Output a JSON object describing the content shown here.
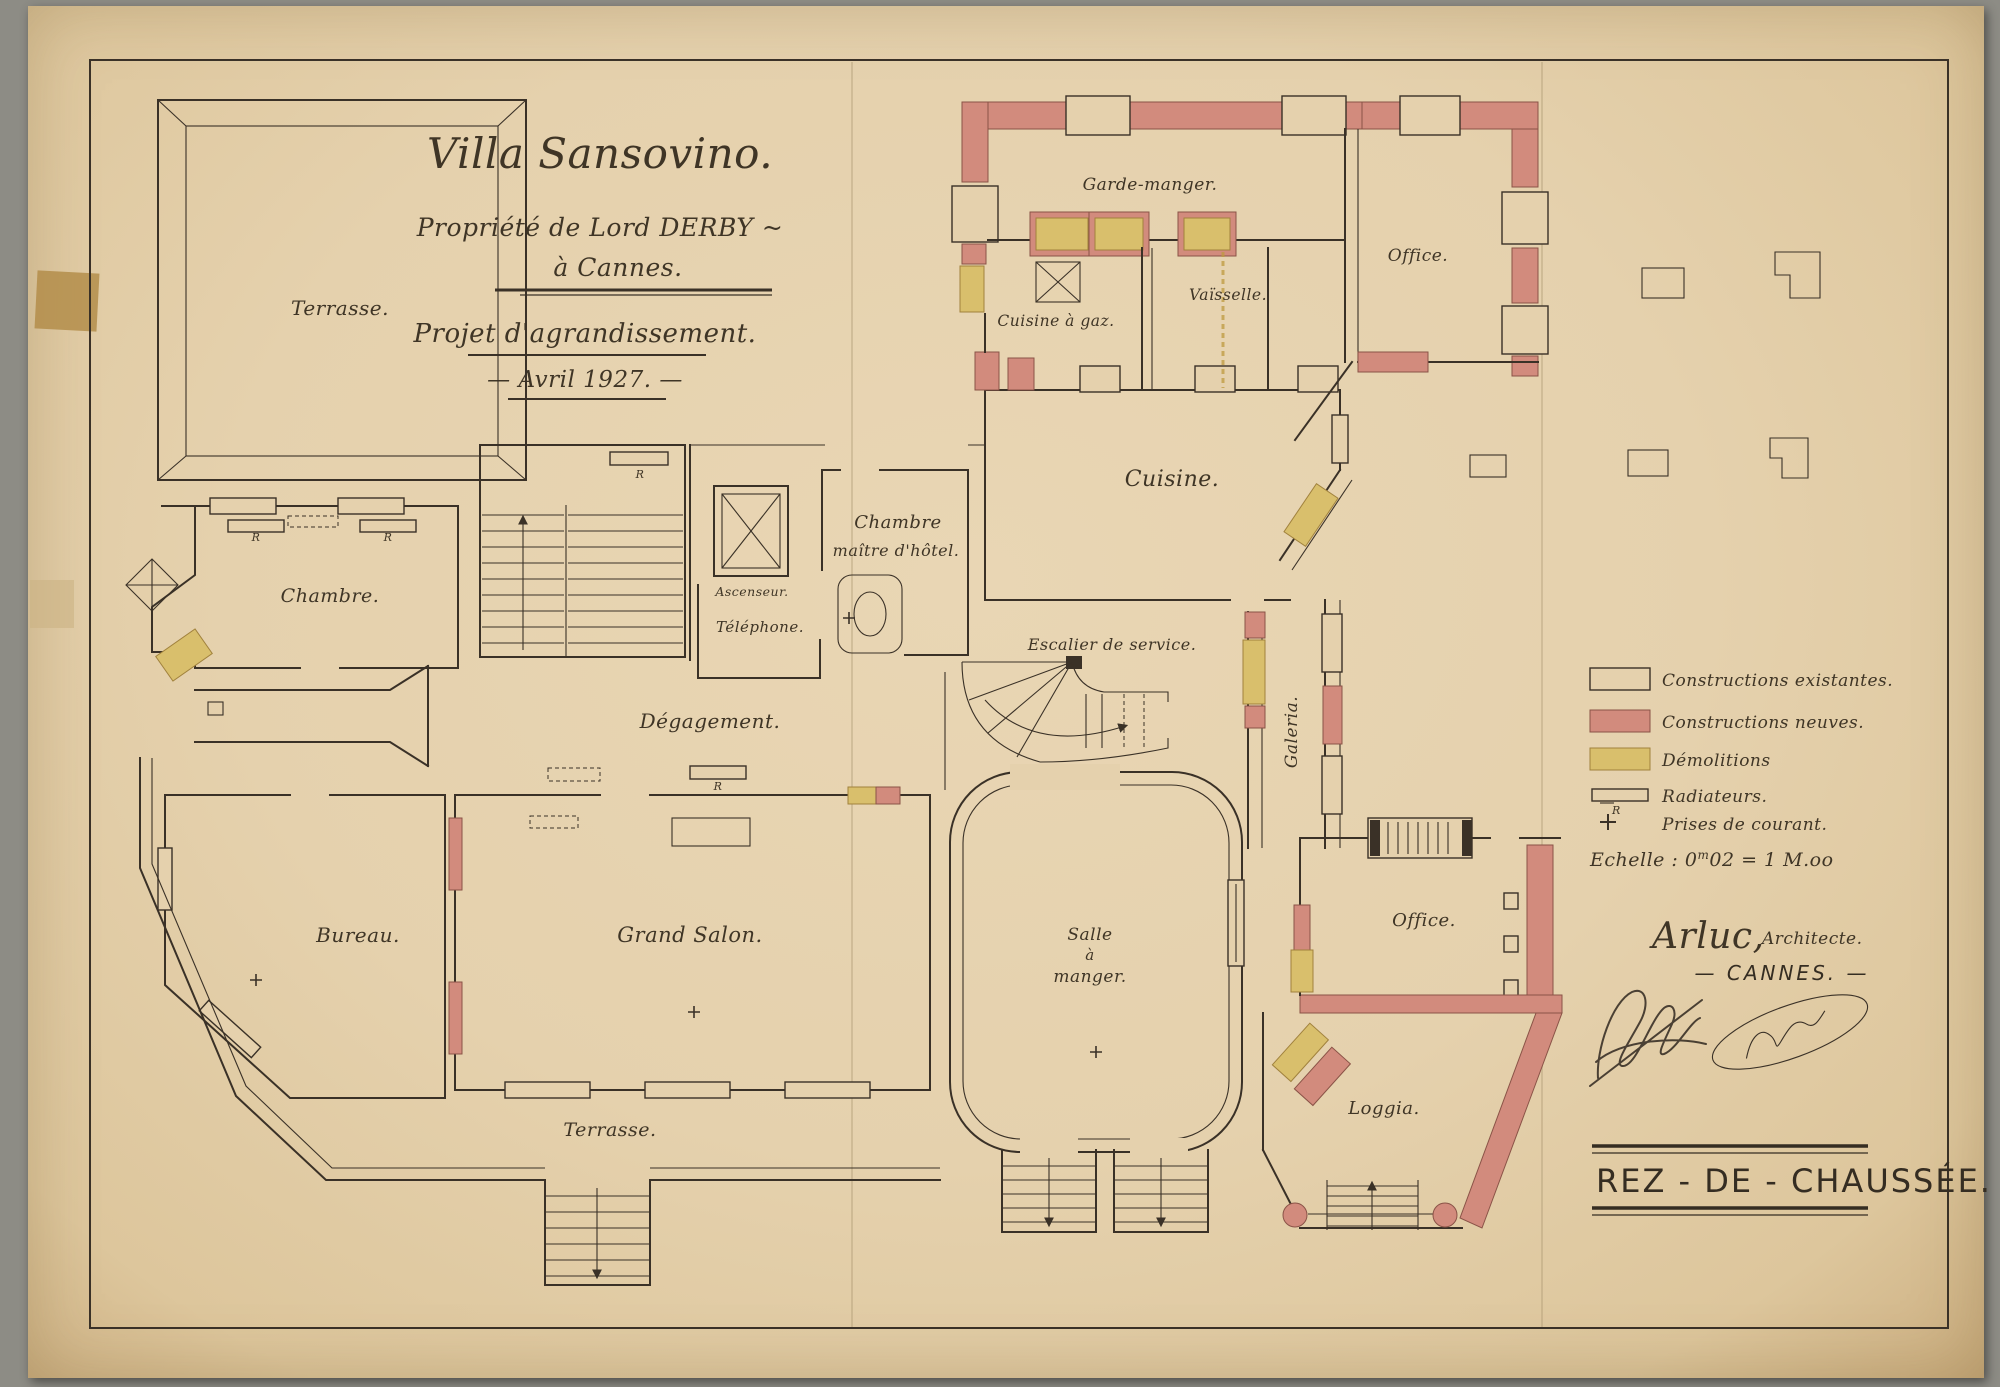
{
  "sheet": {
    "title": "Villa Sansovino.",
    "subtitle_owner": "Propriété de Lord DERBY ~",
    "subtitle_city": "à Cannes.",
    "project": "Projet d'agrandissement.",
    "date": "— Avril 1927. —",
    "floor_label": "REZ - DE - CHAUSSÉE."
  },
  "architect": {
    "name": "Arluc,",
    "title": "Architecte.",
    "city": "— CANNES. —"
  },
  "rooms": {
    "terrasse_nw": "Terrasse.",
    "chambre": "Chambre.",
    "bureau": "Bureau.",
    "grand_salon": "Grand Salon.",
    "terrasse_sud": "Terrasse.",
    "degagement": "Dégagement.",
    "salle_a_manger_l1": "Salle",
    "salle_a_manger_l2": "à",
    "salle_a_manger_l3": "manger.",
    "cuisine": "Cuisine.",
    "garde_manger": "Garde-manger.",
    "cuisine_a_gaz": "Cuisine à gaz.",
    "vaisselle": "Vaïsselle.",
    "office_ne": "Office.",
    "office_est": "Office.",
    "loggia": "Loggia.",
    "galeria": "Galeria.",
    "escalier_service": "Escalier de service.",
    "chambre_maitre_l1": "Chambre",
    "chambre_maitre_l2": "maître d'hôtel.",
    "telephone": "Téléphone.",
    "ascenseur": "Ascenseur."
  },
  "legend": {
    "items": [
      {
        "label": "Constructions existantes.",
        "swatch": "existing"
      },
      {
        "label": "Constructions neuves.",
        "swatch": "new"
      },
      {
        "label": "Démolitions",
        "swatch": "demolition"
      },
      {
        "label": "Radiateurs.",
        "swatch": "radiator"
      },
      {
        "label": "Prises de courant.",
        "swatch": "outlet"
      }
    ],
    "scale_p1": "Echelle : 0",
    "scale_sup": "m",
    "scale_p2": "02 = 1 M.oo",
    "radiator_letter": "R"
  },
  "colors": {
    "paper": "#e5d1ad",
    "ink": "#3a3127",
    "new_construction": "#d28b7d",
    "demolition": "#d9bf6c",
    "photo_background": "#8d8c85"
  }
}
